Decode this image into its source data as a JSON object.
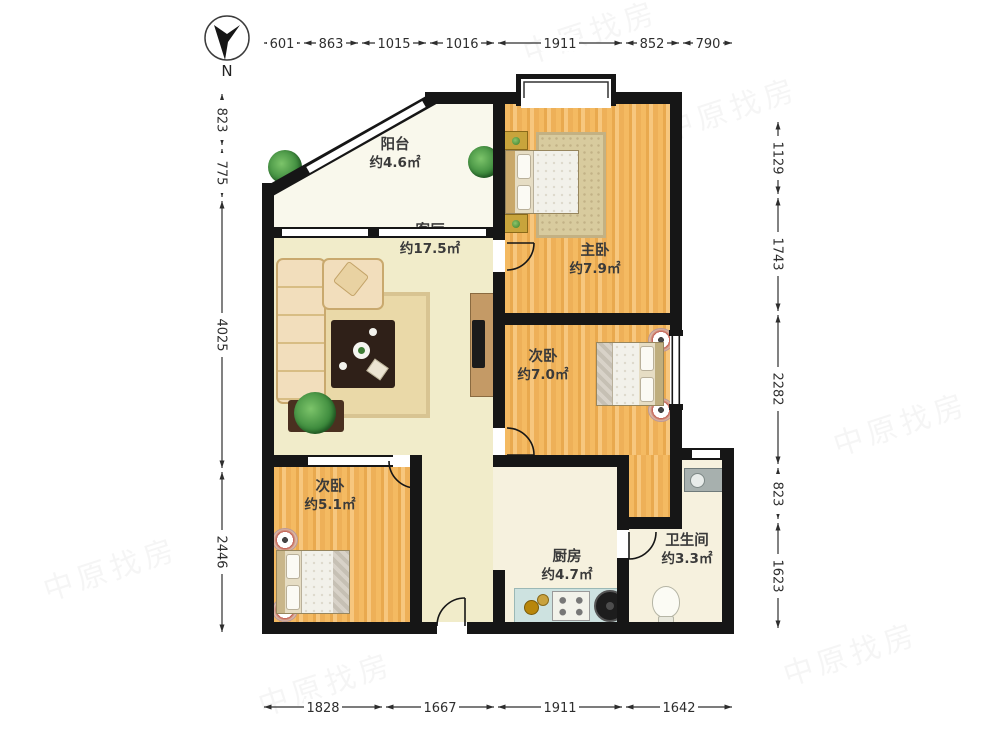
{
  "compass": {
    "label": "N"
  },
  "rooms": {
    "balcony": {
      "name": "阳台",
      "area": "约4.6㎡"
    },
    "living": {
      "name": "客厅",
      "area": "约17.5㎡"
    },
    "master": {
      "name": "主卧",
      "area": "约7.9㎡"
    },
    "bedroom2": {
      "name": "次卧",
      "area": "约7.0㎡"
    },
    "bedroom3": {
      "name": "次卧",
      "area": "约5.1㎡"
    },
    "kitchen": {
      "name": "厨房",
      "area": "约4.7㎡"
    },
    "bathroom": {
      "name": "卫生间",
      "area": "约3.3㎡"
    }
  },
  "dimensions_mm": {
    "top": [
      "601",
      "863",
      "1015",
      "1016",
      "1911",
      "852",
      "790"
    ],
    "left": [
      "823",
      "775",
      "4025",
      "2446"
    ],
    "right": [
      "1129",
      "1743",
      "2282",
      "823",
      "1623"
    ],
    "bottom": [
      "1828",
      "1667",
      "1911",
      "1642"
    ]
  },
  "watermark": {
    "text": "中原找房"
  },
  "colors": {
    "wall": "#161616",
    "wood_floor": "#f0b25c",
    "light_floor": "#f1ecca",
    "balcony_floor": "#f9f8ec",
    "kitchen_counter": "#cde2e0",
    "dimension_text": "#2e2e2e"
  }
}
